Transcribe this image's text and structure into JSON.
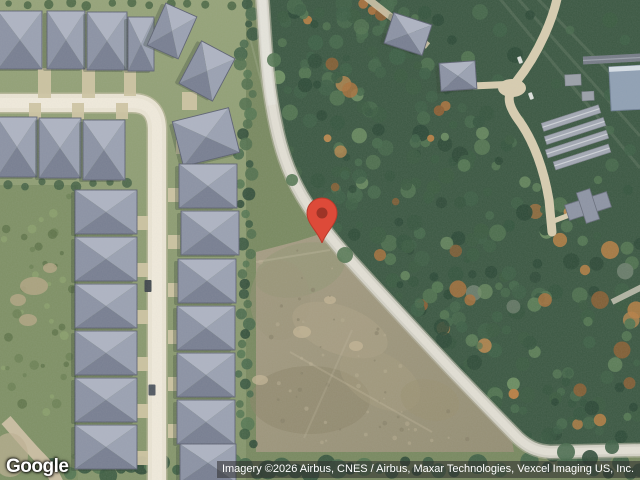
{
  "branding": {
    "logo_text": "Google"
  },
  "attribution": {
    "text": "Imagery ©2026 Airbus, CNES / Airbus, Maxar Technologies, Vexcel Imaging US, Inc."
  },
  "pin": {
    "label": "location marker",
    "x": 322,
    "y": 243
  },
  "colors": {
    "pin_fill": "#dd4a39",
    "pin_inner": "#9e3427",
    "pin_stroke": "#b93a2b",
    "road": "#d4d2c6",
    "road_edge": "#b9b7a5",
    "road_center": "#e6e4d8",
    "street": "#ebe5d4",
    "street_center": "#f3eee0",
    "street_edge": "#cdc4ab",
    "driveway": "#cfc5a2",
    "roof_top": "#aeb4c3",
    "roof_bottom": "#777e91",
    "roof_left": "#8b92a4",
    "roof_right": "#9aa1b2",
    "roof_stroke": "#5b6070",
    "lawn1": "#95a378",
    "lawn2": "#84956a",
    "base_green": "#78895f",
    "scrub": "#7e9064",
    "forest": "#3a5741",
    "clearing": "#8ca16d",
    "field1": "#a59c82",
    "field2": "#948e73",
    "dirt": "#b5a685",
    "storage": "#a2a8b3",
    "storage_ridge": "#ced2d8",
    "blue_roof": "#8fa0b4",
    "attribution_bg": "rgba(45,45,45,0.55)",
    "attribution_fg": "#ffffff",
    "logo_fg": "#ffffff"
  }
}
